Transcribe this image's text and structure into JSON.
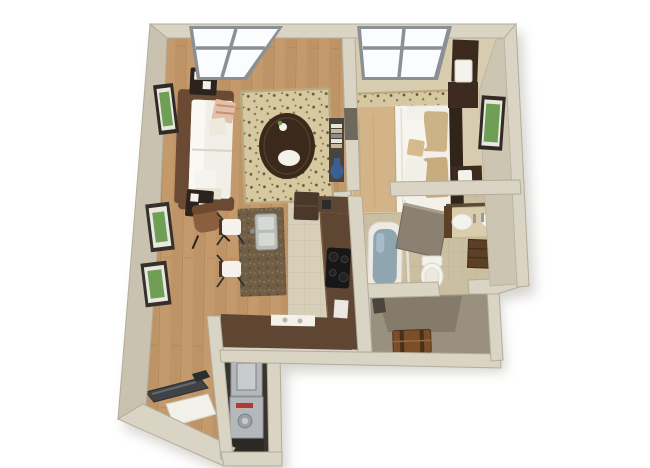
{
  "meta": {
    "description": "3D isometric top-down render of a one-bedroom apartment floor plan on a white background",
    "view": "top-down 3D dollhouse render"
  },
  "rooms": [
    {
      "id": "living-room",
      "furniture": [
        "sofa",
        "coffee-table",
        "area-rug",
        "end-table",
        "accent-chair",
        "wall-art",
        "window",
        "console-shelf"
      ]
    },
    {
      "id": "bedroom",
      "furniture": [
        "bed",
        "headboard",
        "nightstand",
        "lamp",
        "dresser-chest",
        "area-rug",
        "wall-art",
        "window"
      ]
    },
    {
      "id": "kitchen",
      "furniture": [
        "island-with-sink",
        "bar-chair",
        "l-shaped-counter",
        "cooktop",
        "refrigerator",
        "peninsula-counter",
        "serving-tray"
      ]
    },
    {
      "id": "bathroom",
      "furniture": [
        "bathtub",
        "vanity-sink",
        "mirror",
        "toilet",
        "drawer-cabinet",
        "open-door"
      ]
    },
    {
      "id": "walk-in-closet",
      "furniture": [
        "storage-trunk"
      ]
    },
    {
      "id": "laundry-closet",
      "furniture": [
        "stacked-washer-dryer"
      ]
    },
    {
      "id": "entry-hall",
      "furniture": [
        "treadmill",
        "floor-mat"
      ]
    }
  ],
  "palette": {
    "background": "#ffffff",
    "shadow": "#8a8578",
    "wall": "#d9d4c4",
    "wall_left": "#c9c2b0",
    "wall_face": "#ccc5b2",
    "wall_edge": "#b3ac9a",
    "niche_dark": "#6e695f",
    "wood": "#c49a6c",
    "wood_plank": "#b88d5f",
    "wood_seam": "#a87f51",
    "tile_kitchen": "#d8cfba",
    "tile_kitchen_line": "#c6bca4",
    "tile_bath": "#cbbfa2",
    "tile_bath_line": "#bbae8e",
    "floor_bedroom": "#d8ccae",
    "floor_closet": "#99907f",
    "closet_shadow": "#837a6a",
    "laundry_dark": "#38332d",
    "rug": "#d6c8a0",
    "rug_dot": "#6b5733",
    "rug_dot2": "#8d7549",
    "rug_border": "#b9a97e",
    "sofa_frame": "#6b4a33",
    "upholstery": "#f1efe8",
    "pillow_blush": "#e3c0a8",
    "table_dark": "#2c241c",
    "coffee_table": "#3b2a1c",
    "tray_white": "#f3f1ea",
    "accent_chair": "#8a5f3d",
    "shelf_dark": "#4a443c",
    "book_cream": "#e8e4da",
    "book_tan": "#c9b795",
    "book_gray": "#8a8d91",
    "vase_blue": "#3b5f93",
    "counter": "#5f4632",
    "counter_edge": "#7a5c42",
    "island": "#6f5d46",
    "steel": "#b9bcb9",
    "cooktop": "#171717",
    "fridge": "#4a392b",
    "chair_white": "#f4f2ea",
    "chair_frame": "#4a3326",
    "bed_linen": "#f2f0e9",
    "blanket": "#d2b488",
    "pillow_tan": "#cdb287",
    "headboard": "#33241a",
    "nightstand": "#3c2b1e",
    "chest": "#3a2a1d",
    "lamp": "#f4f2ec",
    "tub": "#eceae2",
    "water": "#8fa6b0",
    "vanity_top": "#d9cdac",
    "cabinet": "#5b4026",
    "mirror_strip": "#5a4a38",
    "toilet": "#f3f2ec",
    "door_panel": "#8b8172",
    "trunk": "#7a4e2a",
    "strap": "#4a2f17",
    "dark_item": "#4a463e",
    "appliance": "#b5b8bb",
    "appliance_panel": "#c9ccce",
    "red_indicator": "#b23a2e",
    "dial": "#9aa0a5",
    "treadmill": "#3f4347",
    "treadmill_dark": "#2b2e31",
    "mat": "#f1f0e9",
    "window_frame": "#8b9095",
    "glass": "#fbfcfd",
    "frame_dark": "#2f2a24",
    "frame_mat": "#e9e7df",
    "art_green": "#6f9f55"
  }
}
